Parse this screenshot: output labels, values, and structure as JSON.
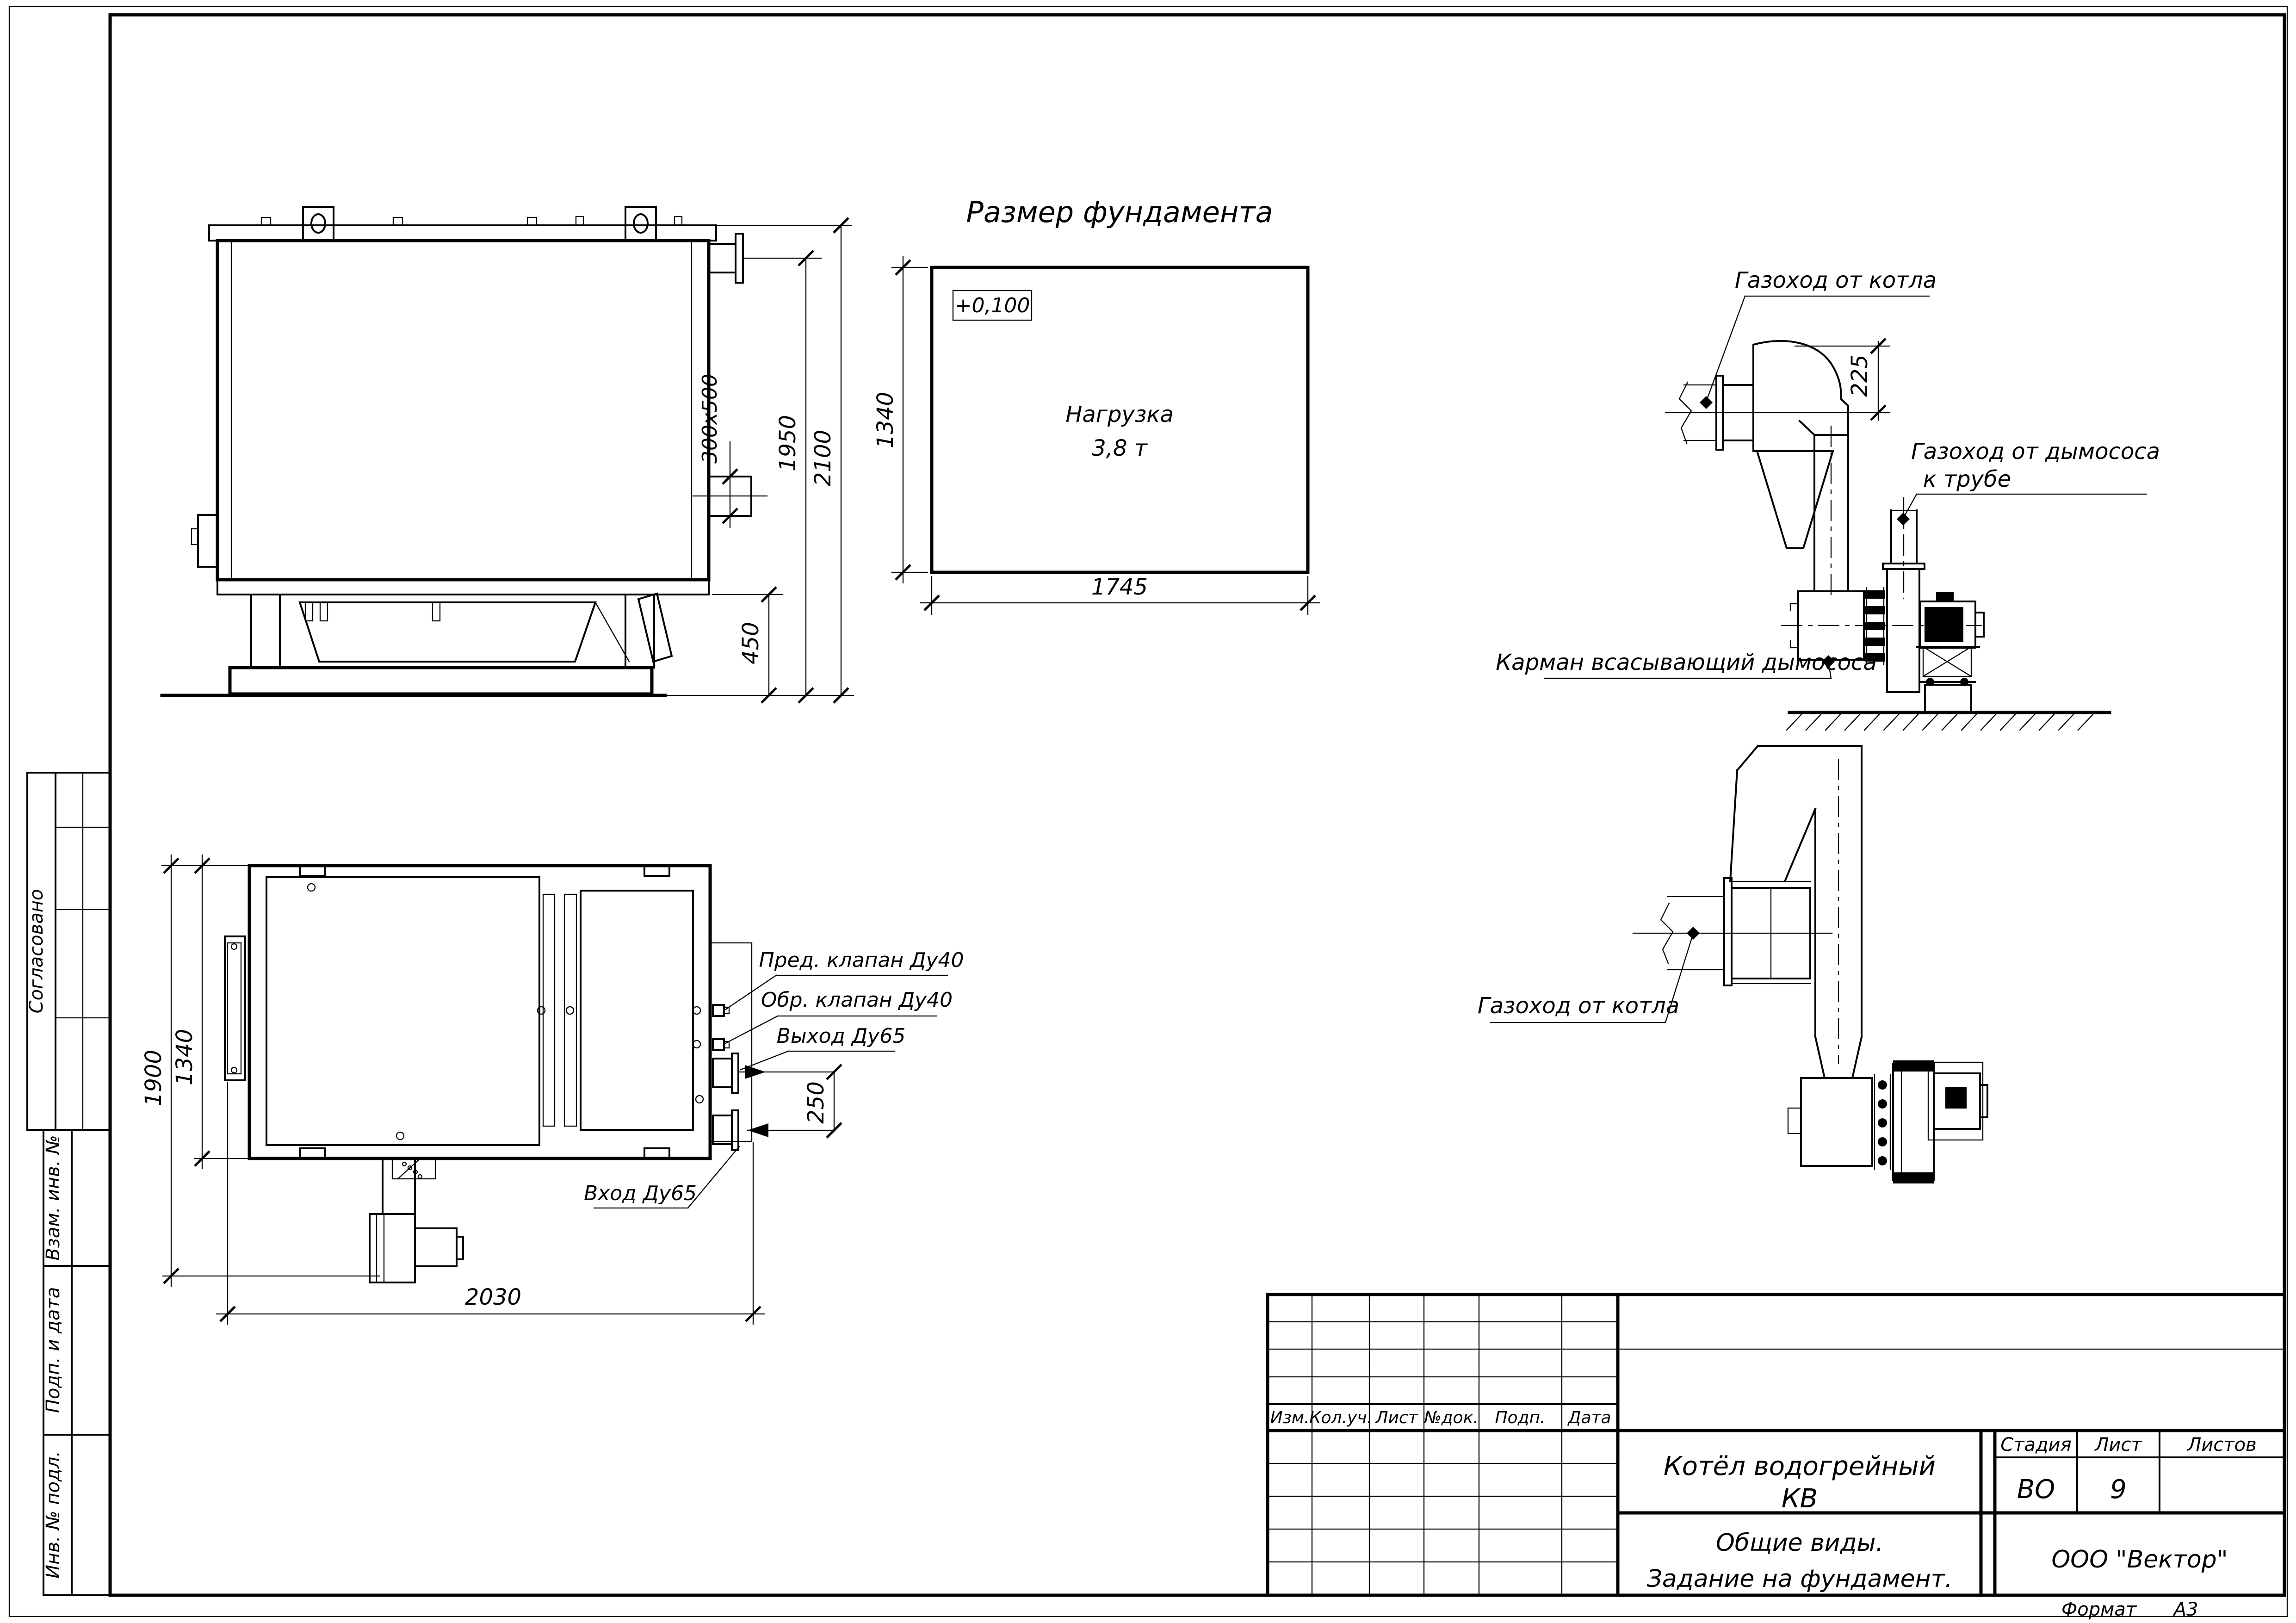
{
  "sheet": {
    "format_label": "Формат",
    "format_value": "А3"
  },
  "title_block": {
    "product_line1": "Котёл водогрейный",
    "product_line2": "КВ",
    "doc_line1": "Общие виды.",
    "doc_line2": "Задание на фундамент.",
    "stage_label": "Стадия",
    "sheet_label": "Лист",
    "sheets_label": "Листов",
    "stage_value": "ВО",
    "sheet_value": "9",
    "sheets_value": "",
    "org_name": "ООО \"Вектор\"",
    "rev_headers": [
      "Изм.",
      "Кол.уч.",
      "Лист",
      "№док.",
      "Подп.",
      "Дата"
    ]
  },
  "side_stamps": {
    "approved": "Согласовано",
    "replaced_inv": "Взам. инв. №",
    "sign_date": "Подп. и дата",
    "inv_original": "Инв. № подл."
  },
  "views": {
    "boiler_side": {
      "dim_total_height": "2100",
      "dim_flange_height": "1950",
      "dim_duct": "300x500",
      "dim_base": "450"
    },
    "foundation": {
      "title": "Размер фундамента",
      "elevation_mark": "+0,100",
      "load_line1": "Нагрузка",
      "load_line2": "3,8 т",
      "dim_width": "1745",
      "dim_depth": "1340"
    },
    "flue_elevation": {
      "label_boiler_duct": "Газоход от котла",
      "label_fan_duct_1": "Газоход от дымососа",
      "label_fan_duct_2": "к трубе",
      "label_pocket": "Карман всасывающий дымососа",
      "dim_offset": "225"
    },
    "flue_plan": {
      "label_boiler_duct": "Газоход от котла"
    },
    "boiler_plan": {
      "label_safety_valve": "Пред. клапан Ду40",
      "label_check_valve": "Обр. клапан Ду40",
      "label_outlet": "Выход Ду65",
      "label_inlet": "Вход Ду65",
      "dim_width": "2030",
      "dim_depth": "1900",
      "dim_inner_depth": "1340",
      "dim_ports": "250"
    }
  }
}
